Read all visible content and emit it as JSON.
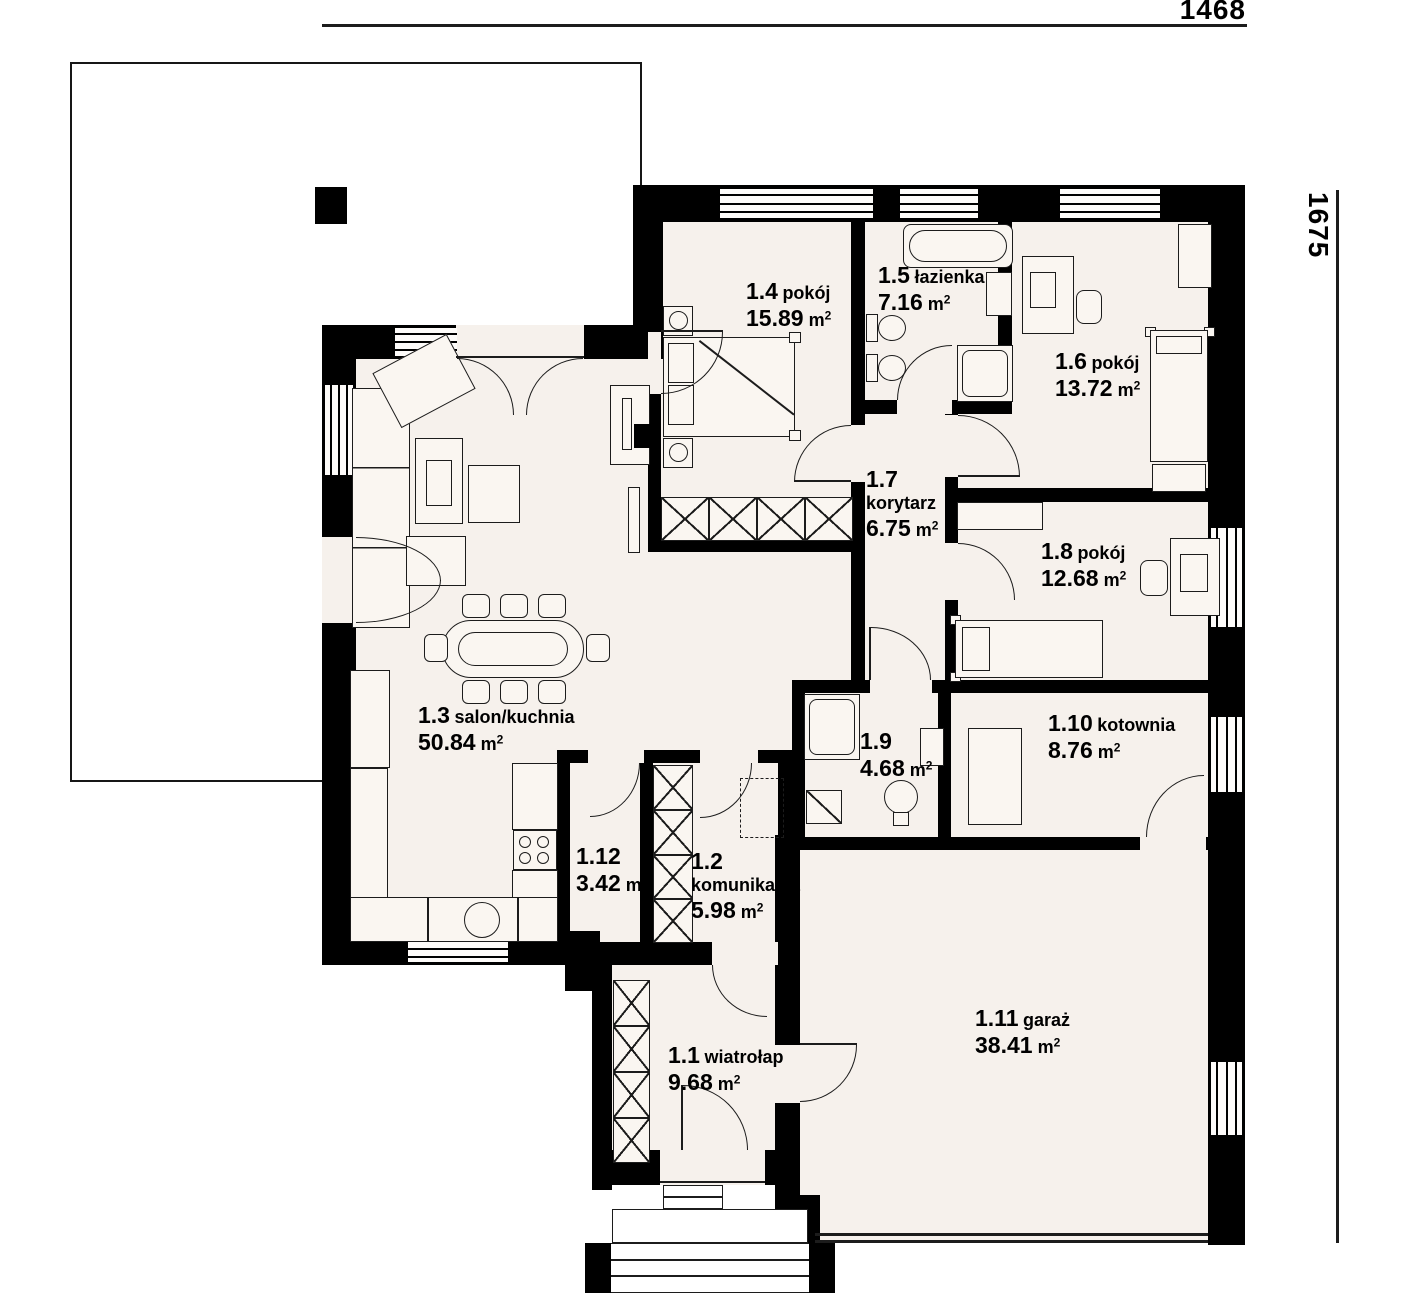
{
  "title": "house floor plan",
  "dimensions": {
    "width_label": "1468",
    "height_label": "1675"
  },
  "units": {
    "area": "m",
    "sup": "2"
  },
  "rooms": [
    {
      "number": "1.1",
      "name": "wiatrołap",
      "area": "9.68"
    },
    {
      "number": "1.2",
      "name": "komunikacja",
      "area": "5.98"
    },
    {
      "number": "1.3",
      "name": "salon/kuchnia",
      "area": "50.84"
    },
    {
      "number": "1.4",
      "name": "pokój",
      "area": "15.89"
    },
    {
      "number": "1.5",
      "name": "łazienka",
      "area": "7.16"
    },
    {
      "number": "1.6",
      "name": "pokój",
      "area": "13.72"
    },
    {
      "number": "1.7",
      "name": "korytarz",
      "area": "6.75"
    },
    {
      "number": "1.8",
      "name": "pokój",
      "area": "12.68"
    },
    {
      "number": "1.9",
      "name": "",
      "area": "4.68"
    },
    {
      "number": "1.10",
      "name": "kotownia",
      "area": "8.76"
    },
    {
      "number": "1.11",
      "name": "garaż",
      "area": "38.41"
    },
    {
      "number": "1.12",
      "name": "",
      "area": "3.42"
    }
  ],
  "colors": {
    "wall": "#000000",
    "floor": "#f6f1ec",
    "stroke": "#1c1c1c",
    "background": "#ffffff"
  }
}
